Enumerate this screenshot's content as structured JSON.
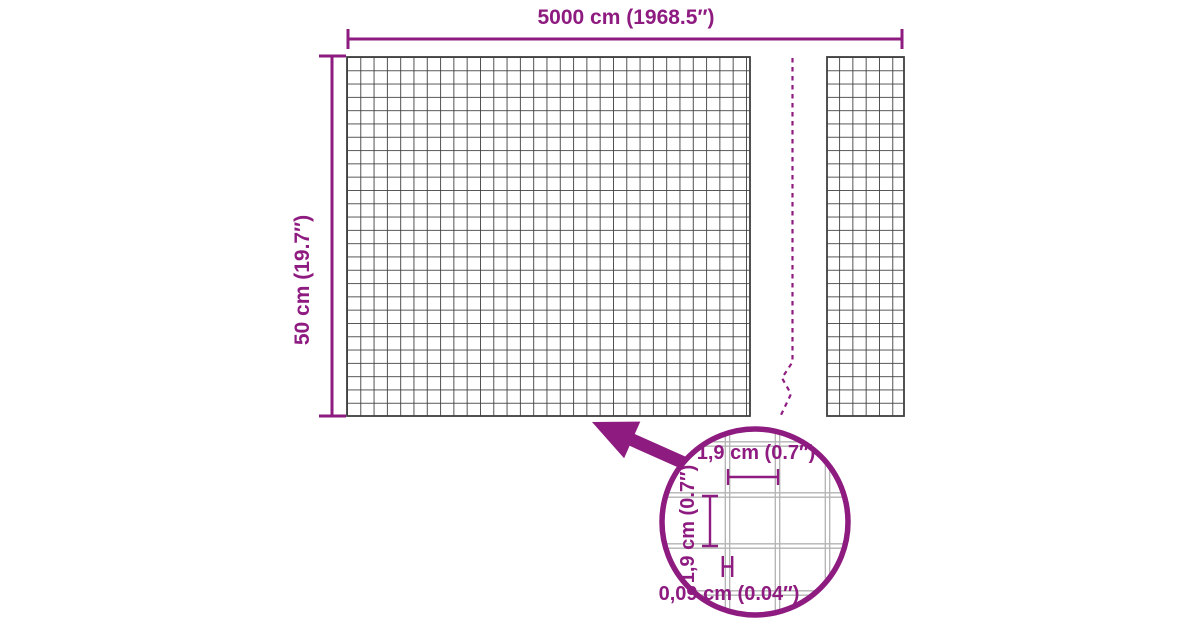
{
  "diagram": {
    "overall": {
      "width_label": "5000 cm (1968.5″)",
      "height_label": "50 cm (19.7″)"
    },
    "detail": {
      "mesh_width_label": "1,9 cm (0.7″)",
      "mesh_height_label": "1,9 cm (0.7″)",
      "wire_thickness_label": "0,09 cm (0.04″)"
    },
    "colors": {
      "accent": "#8E1B80",
      "mesh_line": "#3F3F3F",
      "detail_mesh_line": "#B3B3B3",
      "background": "#FFFFFF"
    }
  }
}
